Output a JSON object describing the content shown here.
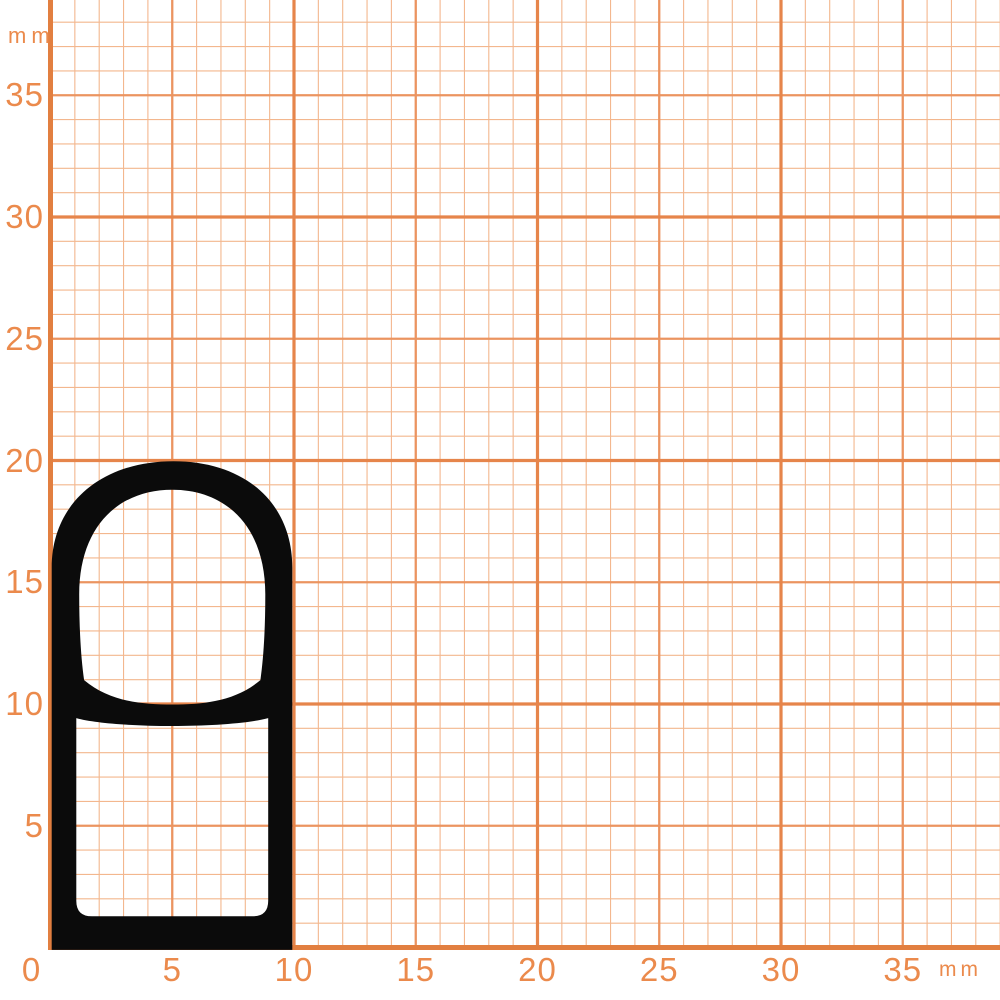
{
  "canvas": {
    "width": 1000,
    "height": 1000,
    "background": "#ffffff"
  },
  "grid": {
    "px_per_mm": 24.35,
    "origin_x_px": 50.5,
    "origin_y_px": 947.5,
    "x_extent_mm": 39,
    "y_extent_mm": 38,
    "colors": {
      "minor": "#f3b78e",
      "medium": "#eb9460",
      "major": "#e6854b",
      "axis": "#e27f40"
    },
    "widths": {
      "minor": 1.1,
      "medium": 2.3,
      "major": 3.2,
      "axis": 5
    }
  },
  "axes": {
    "label_color": "#eb8a4c",
    "x": {
      "unit": "mm",
      "ticks": [
        0,
        5,
        10,
        15,
        20,
        25,
        30,
        35
      ]
    },
    "y": {
      "unit": "mm",
      "ticks": [
        35,
        30,
        25,
        20,
        15,
        10,
        5
      ]
    }
  },
  "unit_labels": {
    "top_left": "mm",
    "bottom_right": "mm"
  },
  "profile": {
    "name": "rubber seal profile cross-section",
    "color": "#0b0b0b",
    "width_mm": 10,
    "height_mm": 20,
    "wall_thickness_mm": 1.1,
    "chambers": 2,
    "outer_path_mm": [
      "M",
      0.05,
      -0.1,
      "L",
      0.05,
      15.6,
      "C",
      0.05,
      18.25,
      2.1,
      19.97,
      5.05,
      19.97,
      "C",
      8.0,
      19.97,
      9.93,
      18.25,
      9.93,
      15.6,
      "L",
      9.93,
      -0.1,
      "Z"
    ],
    "hole_upper_mm": [
      "M",
      1.38,
      10.98,
      "C",
      1.25,
      11.9,
      1.18,
      13.1,
      1.18,
      14.5,
      "C",
      1.18,
      17.25,
      2.75,
      18.8,
      5.0,
      18.8,
      "C",
      7.25,
      18.8,
      8.82,
      17.25,
      8.82,
      14.5,
      "C",
      8.82,
      13.1,
      8.75,
      11.9,
      8.62,
      10.98,
      "C",
      7.6,
      10.12,
      6.3,
      9.98,
      5.0,
      9.98,
      "C",
      3.7,
      9.98,
      2.4,
      10.12,
      1.38,
      10.98,
      "Z"
    ],
    "hole_lower_mm": [
      "M",
      1.06,
      9.42,
      "C",
      2.6,
      8.99,
      7.4,
      8.99,
      8.94,
      9.42,
      "L",
      8.94,
      1.92,
      "Q",
      8.94,
      1.28,
      8.3,
      1.28,
      "L",
      1.7,
      1.28,
      "Q",
      1.06,
      1.28,
      1.06,
      1.92,
      "Z"
    ]
  }
}
